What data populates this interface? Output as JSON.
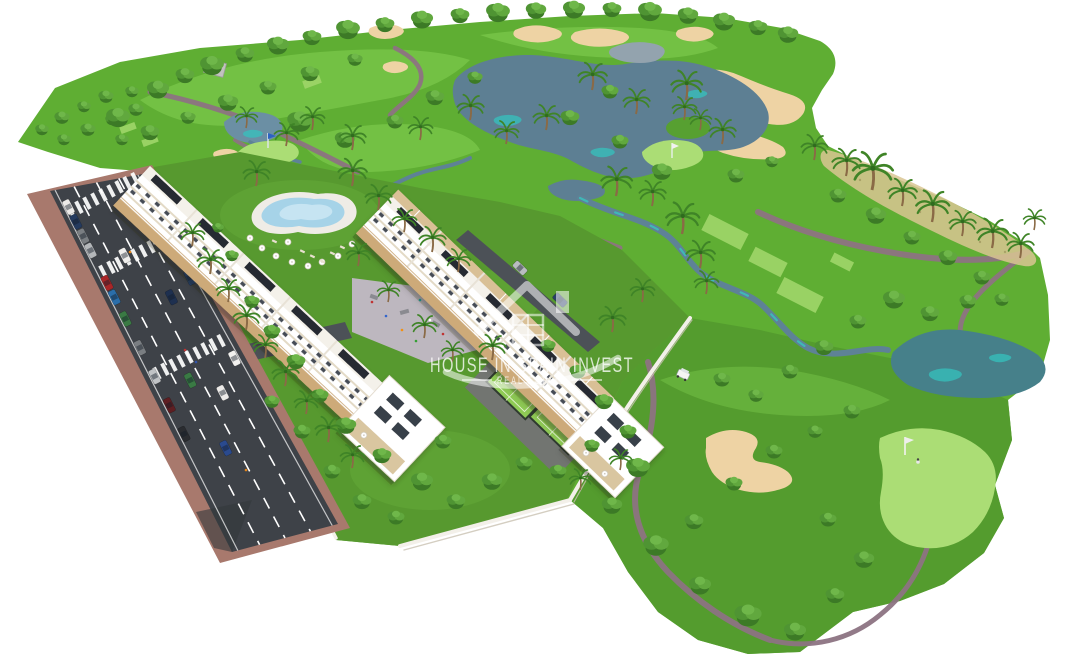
{
  "watermark": {
    "title": "HOUSE IN SPAIN INVEST",
    "subtitle": "REAL ESTATE",
    "logo_icon": "house-logo-icon"
  },
  "scene": {
    "type": "aerial-3d-architectural-render",
    "subject": "Golf resort apartment development: two white apartment blocks with rooftop solar panels, lagoon pool, playground plaza, paddle courts, perimeter road with parked cars, and a golf course with lakes, sand bunkers, cart paths and palm trees",
    "colors": {
      "background": "#ffffff",
      "fairway": "#5fae33",
      "fairway_light": "#79c649",
      "rough": "#539b2e",
      "lawn": "#57992f",
      "green_putting": "#abdd75",
      "tee": "#9cd468",
      "lake": "#5d7f93",
      "lake_teal": "#46808a",
      "turquoise": "#35c2bd",
      "pond_gray": "#93a3ae",
      "sand": "#eed3a4",
      "scrub_sand": "#d9c693",
      "cart_path": "#8d7382",
      "road": "#3e4248",
      "sidewalk": "#a8796d",
      "driveway": "#4c5157",
      "building_white": "#ffffff",
      "roof_deck": "#f4f1ea",
      "balcony_beige": "#cdaa79",
      "solar_panel": "#262b30",
      "pool_water": "#a6d3e8",
      "pool_deck": "#efece6",
      "court_green": "#8fcb55",
      "plaza_gray": "#bdb7bf",
      "wall_white": "#f3f0e9",
      "watermark_white": "#ffffff"
    }
  }
}
